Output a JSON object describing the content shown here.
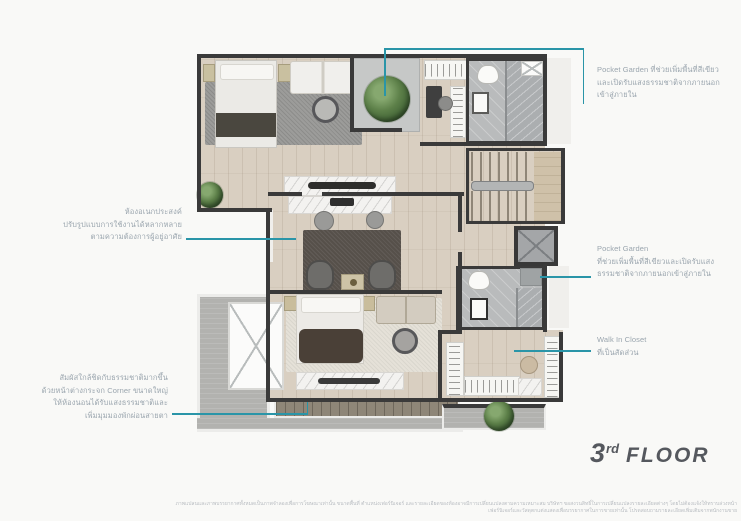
{
  "colors": {
    "accent": "#2a95a8",
    "annotation_text": "#9aa5ae",
    "wall": "#3a3a3a",
    "floor_label": "#55585e"
  },
  "floor_label": {
    "number": "3",
    "ordinal": "rd",
    "word": "FLOOR"
  },
  "annotations": {
    "pocket_garden_top": {
      "lines": [
        "Pocket Garden ที่ช่วยเพิ่มพื้นที่สีเขียว",
        "และเปิดรับแสงธรรมชาติจากภายนอก",
        "เข้าสู่ภายใน"
      ]
    },
    "pocket_garden_mid": {
      "title": "Pocket Garden",
      "lines": [
        "ที่ช่วยเพิ่มพื้นที่สีเขียวและเปิดรับแสง",
        "ธรรมชาติจากภายนอกเข้าสู่ภายใน"
      ]
    },
    "walk_in_closet": {
      "title": "Walk In Closet",
      "lines": [
        "ที่เป็นสัดส่วน"
      ]
    },
    "multipurpose_room": {
      "lines": [
        "ห้องอเนกประสงค์",
        "ปรับรูปแบบการใช้งานได้หลากหลาย",
        "ตามความต้องการผู้อยู่อาศัย"
      ]
    },
    "corner_window": {
      "lines": [
        "สัมผัสใกล้ชิดกับธรรมชาติมากขึ้น",
        "ด้วยหน้าต่างกระจก Corner ขนาดใหญ่",
        "ให้ห้องนอนได้รับแสงธรรมชาติและ",
        "เพิ่มมุมมองพักผ่อนสายตา"
      ]
    }
  },
  "disclaimer": {
    "lines": [
      "ภาพแปลนและภาพบรรยากาศทั้งหมดเป็นภาพจำลองเพื่อการโฆษณาเท่านั้น ขนาดพื้นที่ ตำแหน่งเฟอร์นิเจอร์ และรายละเอียดของห้องอาจมีการเปลี่ยนแปลงตามความเหมาะสม บริษัทฯ ขอสงวนสิทธิ์ในการเปลี่ยนแปลงรายละเอียดต่างๆ โดยไม่ต้องแจ้งให้ทราบล่วงหน้า",
      "เฟอร์นิเจอร์และวัสดุตกแต่งแสดงเพื่อบรรยากาศในการขายเท่านั้น โปรดสอบถามรายละเอียดเพิ่มเติมจากพนักงานขาย"
    ]
  }
}
